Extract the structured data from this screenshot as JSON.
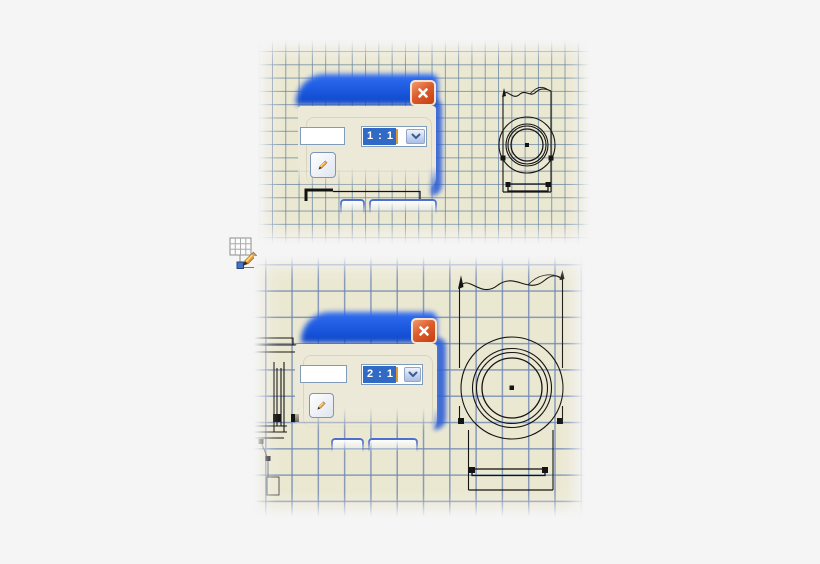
{
  "ui": {
    "sheet_top": {
      "scale_value": "1 : 1",
      "label_value": ""
    },
    "sheet_bottom": {
      "scale_value": "2 : 1",
      "label_value": ""
    }
  },
  "icons": {
    "close": "x-cross",
    "chevron_down": "chevron-down",
    "pencil": "pencil",
    "edit_view": "grid-with-pencil"
  },
  "colors": {
    "paper": "#ebe8d2",
    "grid_line_top": "#64829f",
    "grid_line_bottom": "#6e87b4",
    "titlebar_blue": "#1552d8",
    "close_red": "#c43f12",
    "selection_blue": "#316ac5",
    "caret_orange": "#e09d2e",
    "drawing_ink": "#141414",
    "background": "#f5f5f6"
  }
}
